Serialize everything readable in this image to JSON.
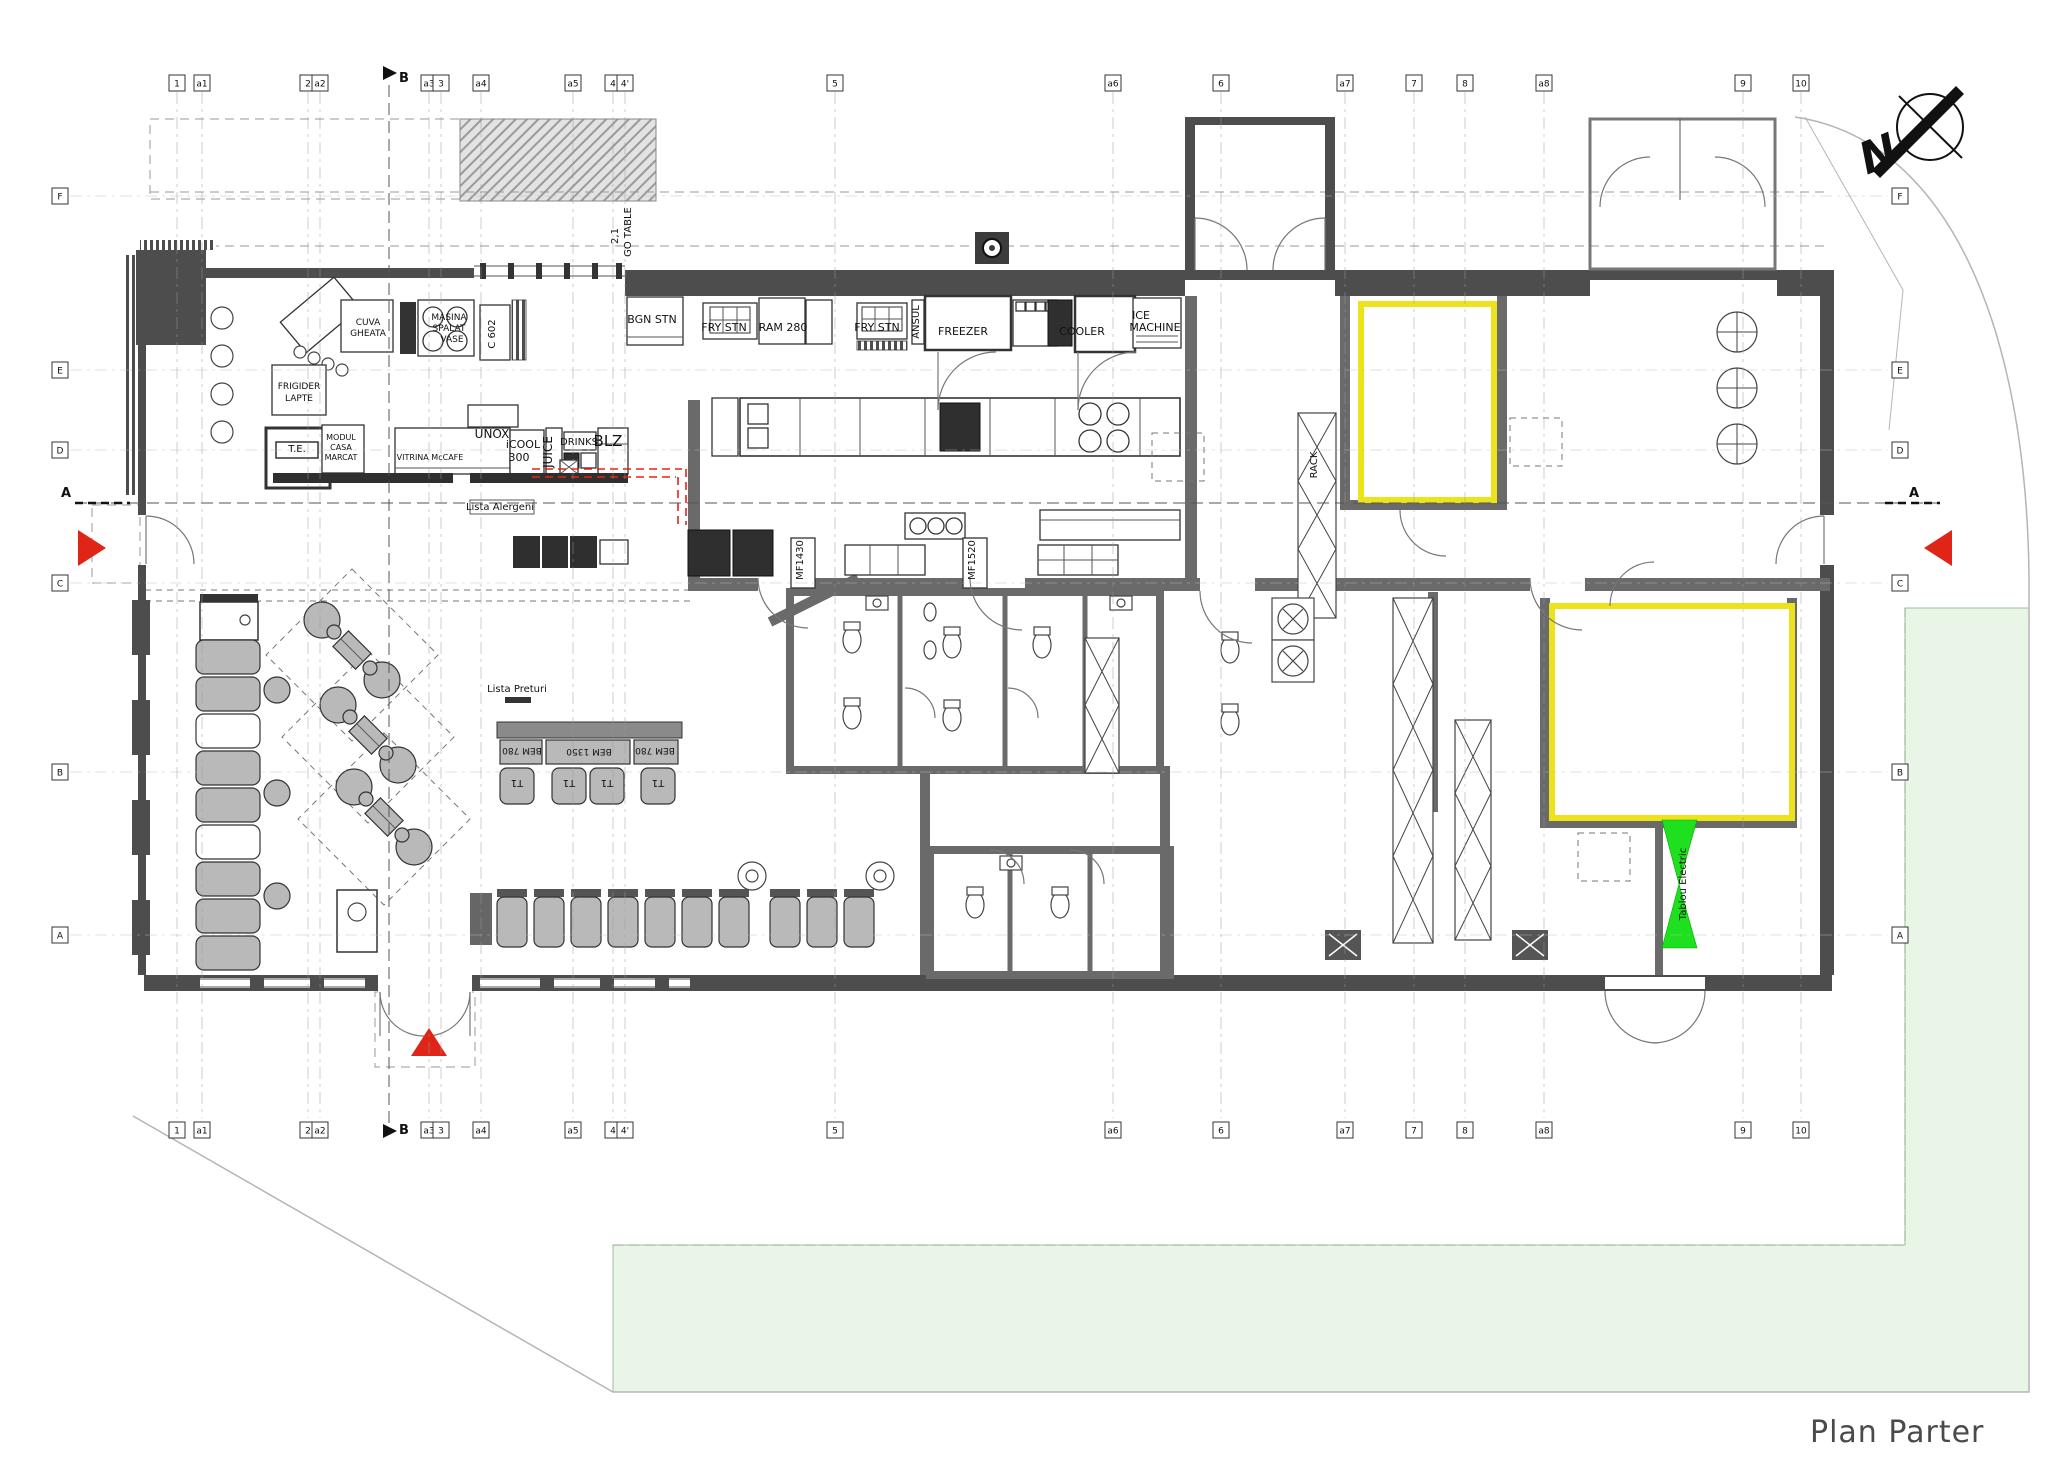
{
  "title": {
    "text": "Plan Parter"
  },
  "compass": {
    "north": "N"
  },
  "colors": {
    "wall": "#4d4d4d",
    "partition": "#6a6a6a",
    "accent_red": "#e02418",
    "accent_yellow": "#ede31a",
    "accent_green": "#1fe01f",
    "lawn": "#e9f5e6",
    "furniture": "#b9b9b9",
    "counter_dark": "#2f2f2f",
    "red_dashed": "#e02418"
  },
  "section_markers": [
    {
      "label": "A",
      "x": 66,
      "y": 497
    },
    {
      "label": "A",
      "x": 1914,
      "y": 497
    },
    {
      "label": "B",
      "x": 404,
      "y": 82
    },
    {
      "label": "B",
      "x": 404,
      "y": 1134
    }
  ],
  "grid": {
    "top": [
      {
        "label": "1",
        "x": 177
      },
      {
        "label": "a1",
        "x": 202
      },
      {
        "label": "2",
        "x": 308
      },
      {
        "label": "a2",
        "x": 320
      },
      {
        "label": "a3",
        "x": 429
      },
      {
        "label": "3",
        "x": 441
      },
      {
        "label": "a4",
        "x": 481
      },
      {
        "label": "a5",
        "x": 573
      },
      {
        "label": "4",
        "x": 613
      },
      {
        "label": "4'",
        "x": 625
      },
      {
        "label": "5",
        "x": 835
      },
      {
        "label": "a6",
        "x": 1113
      },
      {
        "label": "6",
        "x": 1221
      },
      {
        "label": "a7",
        "x": 1345
      },
      {
        "label": "7",
        "x": 1414
      },
      {
        "label": "8",
        "x": 1465
      },
      {
        "label": "a8",
        "x": 1544
      },
      {
        "label": "9",
        "x": 1743
      },
      {
        "label": "10",
        "x": 1801
      }
    ],
    "left": [
      {
        "label": "F",
        "y": 196
      },
      {
        "label": "E",
        "y": 370
      },
      {
        "label": "D",
        "y": 450
      },
      {
        "label": "C",
        "y": 583
      },
      {
        "label": "B",
        "y": 772
      },
      {
        "label": "A",
        "y": 935
      }
    ]
  },
  "plan_labels": [
    {
      "text": "BGN STN",
      "x": 652,
      "y": 323,
      "s": 11
    },
    {
      "text": "FRY STN",
      "x": 724,
      "y": 331,
      "s": 11
    },
    {
      "text": "RAM 280",
      "x": 783,
      "y": 331,
      "s": 11
    },
    {
      "text": "FRY STN",
      "x": 877,
      "y": 331,
      "s": 11
    },
    {
      "text": "ANSUL",
      "x": 919,
      "y": 322,
      "s": 10,
      "rot": -90
    },
    {
      "text": "FREEZER",
      "x": 963,
      "y": 335,
      "s": 11
    },
    {
      "text": "COOLER",
      "x": 1082,
      "y": 335,
      "s": 11
    },
    {
      "text": "ICE",
      "x": 1141,
      "y": 319,
      "s": 11
    },
    {
      "text": "MACHINE",
      "x": 1155,
      "y": 331,
      "s": 11
    },
    {
      "text": "C 602",
      "x": 495,
      "y": 334,
      "s": 10,
      "rot": -90
    },
    {
      "text": "CUVA",
      "x": 368,
      "y": 325,
      "s": 9
    },
    {
      "text": "GHEATA",
      "x": 368,
      "y": 336,
      "s": 9
    },
    {
      "text": "MASINA",
      "x": 449,
      "y": 320,
      "s": 9
    },
    {
      "text": "SPALAT",
      "x": 449,
      "y": 331,
      "s": 9
    },
    {
      "text": "VASE",
      "x": 452,
      "y": 342,
      "s": 9
    },
    {
      "text": "FRIGIDER",
      "x": 299,
      "y": 389,
      "s": 9
    },
    {
      "text": "LAPTE",
      "x": 299,
      "y": 401,
      "s": 9
    },
    {
      "text": "T.E.",
      "x": 297,
      "y": 452,
      "s": 10
    },
    {
      "text": "MODUL",
      "x": 341,
      "y": 440,
      "s": 8
    },
    {
      "text": "CASA",
      "x": 341,
      "y": 450,
      "s": 8
    },
    {
      "text": "MARCAT",
      "x": 341,
      "y": 460,
      "s": 8
    },
    {
      "text": "VITRINA McCAFE",
      "x": 430,
      "y": 460,
      "s": 8
    },
    {
      "text": "UNOX",
      "x": 492,
      "y": 438,
      "s": 12
    },
    {
      "text": "iCOOL",
      "x": 523,
      "y": 448,
      "s": 11
    },
    {
      "text": "300",
      "x": 519,
      "y": 461,
      "s": 11
    },
    {
      "text": "JUICE",
      "x": 552,
      "y": 452,
      "s": 12,
      "rot": -90
    },
    {
      "text": "DRINKS",
      "x": 579,
      "y": 445,
      "s": 10
    },
    {
      "text": "BLZ",
      "x": 608,
      "y": 446,
      "s": 15
    },
    {
      "text": "Lista Alergeni",
      "x": 500,
      "y": 510,
      "s": 10
    },
    {
      "text": "Lista Preturi",
      "x": 517,
      "y": 692,
      "s": 10
    },
    {
      "text": "BEM 780",
      "x": 522,
      "y": 748,
      "s": 9,
      "rot": 180
    },
    {
      "text": "BEM 1350",
      "x": 589,
      "y": 749,
      "s": 9,
      "rot": 180
    },
    {
      "text": "BEM 780",
      "x": 655,
      "y": 748,
      "s": 9,
      "rot": 180
    },
    {
      "text": "T1",
      "x": 517,
      "y": 780,
      "s": 10,
      "rot": 180
    },
    {
      "text": "T1",
      "x": 569,
      "y": 780,
      "s": 10,
      "rot": 180
    },
    {
      "text": "T1",
      "x": 607,
      "y": 780,
      "s": 10,
      "rot": 180
    },
    {
      "text": "T1",
      "x": 658,
      "y": 780,
      "s": 10,
      "rot": 180
    },
    {
      "text": "MF1430",
      "x": 803,
      "y": 560,
      "s": 10,
      "rot": -90
    },
    {
      "text": "MF1520",
      "x": 975,
      "y": 560,
      "s": 10,
      "rot": -90
    },
    {
      "text": "RACK",
      "x": 1317,
      "y": 465,
      "s": 10,
      "rot": -90
    },
    {
      "text": "Tablou Electric",
      "x": 1686,
      "y": 884,
      "s": 10,
      "rot": -90
    },
    {
      "text": "2,1",
      "x": 618,
      "y": 236,
      "s": 10,
      "rot": -90
    },
    {
      "text": "GO TABLE",
      "x": 631,
      "y": 232,
      "s": 10,
      "rot": -90
    },
    {
      "text": "N",
      "x": 1884,
      "y": 168,
      "s": 44,
      "rot": -22,
      "b": 1,
      "i": 1,
      "n": "compass-north-label"
    }
  ]
}
